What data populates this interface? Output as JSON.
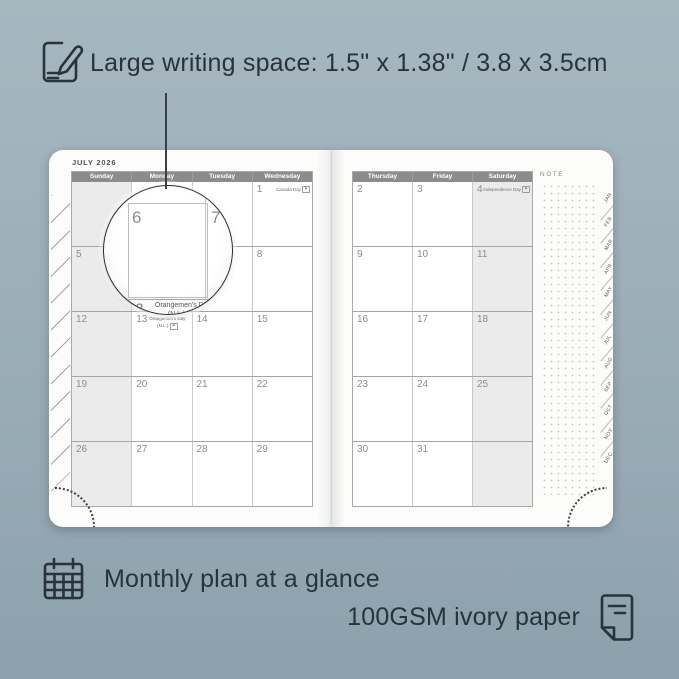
{
  "colors": {
    "background_top": "#a6b7c0",
    "background_bottom": "#8da1ad",
    "ink": "#28333c",
    "header_bar": "#8c8c8c",
    "shaded_column": "#ebebeb",
    "page": "#fcfcfa",
    "grid_line": "#c9c9c9",
    "date_number": "#8d8d8d"
  },
  "callouts": {
    "top": {
      "icon": "pencil-note-icon",
      "text": "Large writing space: 1.5\" x 1.38\" / 3.8 x 3.5cm"
    },
    "bottom_left": {
      "icon": "calendar-grid-icon",
      "text": "Monthly plan at a glance"
    },
    "bottom_right": {
      "icon": "paper-sheet-icon",
      "text": "100GSM ivory paper"
    }
  },
  "planner": {
    "month_title": "JULY 2026",
    "note_label": "NOTE",
    "tabs": [
      "JAN",
      "FEB",
      "MAR",
      "APR",
      "MAY",
      "JUN",
      "JUL",
      "AUG",
      "SEP",
      "OCT",
      "NOV",
      "DEC"
    ],
    "left_page": {
      "day_headers": [
        "Sunday",
        "Monday",
        "Tuesday",
        "Wednesday"
      ],
      "shaded_column_index": 0,
      "rows": [
        [
          {
            "date": ""
          },
          {
            "date": ""
          },
          {
            "date": ""
          },
          {
            "date": "1",
            "holiday": "Canada Day",
            "flag": true
          }
        ],
        [
          {
            "date": "5"
          },
          {
            "date": "6"
          },
          {
            "date": "7"
          },
          {
            "date": "8"
          }
        ],
        [
          {
            "date": "12"
          },
          {
            "date": "13",
            "holiday": "Orangemen's Day",
            "holiday2": "(N.L.)",
            "flag": true
          },
          {
            "date": "14"
          },
          {
            "date": "15"
          }
        ],
        [
          {
            "date": "19"
          },
          {
            "date": "20"
          },
          {
            "date": "21"
          },
          {
            "date": "22"
          }
        ],
        [
          {
            "date": "26"
          },
          {
            "date": "27"
          },
          {
            "date": "28"
          },
          {
            "date": "29"
          }
        ]
      ]
    },
    "right_page": {
      "day_headers": [
        "Thursday",
        "Friday",
        "Saturday"
      ],
      "shaded_column_index": 2,
      "rows": [
        [
          {
            "date": "2"
          },
          {
            "date": "3"
          },
          {
            "date": "4",
            "holiday": "Independence Day",
            "flag": true
          }
        ],
        [
          {
            "date": "9"
          },
          {
            "date": "10"
          },
          {
            "date": "11"
          }
        ],
        [
          {
            "date": "16"
          },
          {
            "date": "17"
          },
          {
            "date": "18"
          }
        ],
        [
          {
            "date": "23"
          },
          {
            "date": "24"
          },
          {
            "date": "25"
          }
        ],
        [
          {
            "date": "30"
          },
          {
            "date": "31"
          },
          {
            "date": ""
          }
        ]
      ]
    }
  },
  "magnifier": {
    "day_top_left": "6",
    "day_top_right": "7",
    "day_bottom": "13",
    "holiday_line1": "Orangemen's Day",
    "holiday_line2": "(N.L.)"
  }
}
